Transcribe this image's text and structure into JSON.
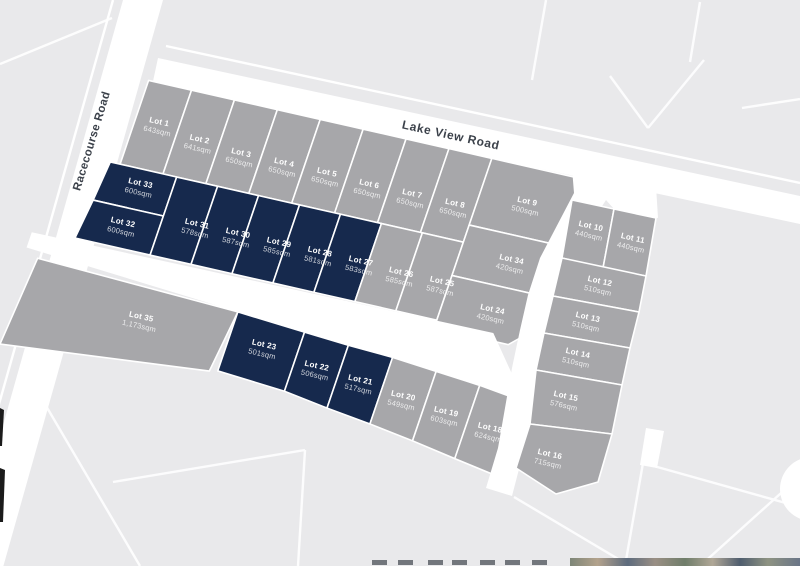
{
  "map": {
    "colors": {
      "background": "#e9e9eb",
      "lot_grey": "#a7a7aa",
      "lot_navy": "#16294d",
      "road": "#ffffff",
      "parcel_line": "#ffffff",
      "label_text": "#ffffff",
      "road_label_text": "#3b414a"
    },
    "roads": {
      "racecourse": {
        "label": "Racecourse Road"
      },
      "lake_view": {
        "label": "Lake View Road"
      }
    },
    "lots": [
      {
        "name": "Lot 1",
        "size": "643sqm",
        "highlight": false,
        "group": "main",
        "points": [
          [
            0,
            -8
          ],
          [
            44,
            -8
          ],
          [
            44,
            80
          ],
          [
            0,
            80
          ]
        ],
        "label": [
          24,
          34
        ]
      },
      {
        "name": "Lot 2",
        "size": "641sqm",
        "highlight": false,
        "group": "main",
        "points": [
          [
            44,
            -8
          ],
          [
            88,
            -8
          ],
          [
            88,
            80
          ],
          [
            44,
            80
          ]
        ],
        "label": [
          68,
          42
        ]
      },
      {
        "name": "Lot 3",
        "size": "650sqm",
        "highlight": false,
        "group": "main",
        "points": [
          [
            88,
            -8
          ],
          [
            132,
            -8
          ],
          [
            132,
            80
          ],
          [
            88,
            80
          ]
        ],
        "label": [
          112,
          46
        ]
      },
      {
        "name": "Lot 4",
        "size": "650sqm",
        "highlight": false,
        "group": "main",
        "points": [
          [
            132,
            -8
          ],
          [
            176,
            -8
          ],
          [
            176,
            80
          ],
          [
            132,
            80
          ]
        ],
        "label": [
          156,
          46
        ]
      },
      {
        "name": "Lot 5",
        "size": "650sqm",
        "highlight": false,
        "group": "main",
        "points": [
          [
            176,
            -8
          ],
          [
            220,
            -8
          ],
          [
            220,
            80
          ],
          [
            176,
            80
          ]
        ],
        "label": [
          200,
          46
        ]
      },
      {
        "name": "Lot 6",
        "size": "650sqm",
        "highlight": false,
        "group": "main",
        "points": [
          [
            220,
            -8
          ],
          [
            264,
            -8
          ],
          [
            264,
            80
          ],
          [
            220,
            80
          ]
        ],
        "label": [
          244,
          48
        ]
      },
      {
        "name": "Lot 7",
        "size": "650sqm",
        "highlight": false,
        "group": "main",
        "points": [
          [
            264,
            -8
          ],
          [
            308,
            -8
          ],
          [
            308,
            80
          ],
          [
            264,
            80
          ]
        ],
        "label": [
          288,
          48
        ]
      },
      {
        "name": "Lot 8",
        "size": "650sqm",
        "highlight": false,
        "group": "main",
        "points": [
          [
            308,
            -8
          ],
          [
            352,
            -8
          ],
          [
            352,
            80
          ],
          [
            308,
            80
          ]
        ],
        "label": [
          332,
          48
        ]
      },
      {
        "name": "Lot 9",
        "size": "500sqm",
        "highlight": false,
        "group": "main",
        "points": [
          [
            352,
            -8
          ],
          [
            448,
            -8
          ],
          [
            448,
            62
          ],
          [
            352,
            62
          ]
        ],
        "label": [
          400,
          30
        ]
      },
      {
        "name": "Lot 33",
        "size": "600sqm",
        "highlight": true,
        "group": "main",
        "points": [
          [
            -10,
            80
          ],
          [
            58,
            80
          ],
          [
            58,
            121
          ],
          [
            -14,
            121
          ]
        ],
        "label": [
          26,
          98
        ]
      },
      {
        "name": "Lot 32",
        "size": "600sqm",
        "highlight": true,
        "group": "main",
        "points": [
          [
            -14,
            121
          ],
          [
            58,
            121
          ],
          [
            58,
            162
          ],
          [
            -19,
            162
          ]
        ],
        "label": [
          22,
          140
        ]
      },
      {
        "name": "Lot 31",
        "size": "578sqm",
        "highlight": true,
        "group": "main",
        "points": [
          [
            58,
            80
          ],
          [
            100,
            80
          ],
          [
            100,
            162
          ],
          [
            58,
            162
          ]
        ],
        "label": [
          93,
          125
        ]
      },
      {
        "name": "Lot 30",
        "size": "587sqm",
        "highlight": true,
        "group": "main",
        "points": [
          [
            100,
            80
          ],
          [
            142,
            80
          ],
          [
            142,
            162
          ],
          [
            100,
            162
          ]
        ],
        "label": [
          135,
          125
        ]
      },
      {
        "name": "Lot 29",
        "size": "585sqm",
        "highlight": true,
        "group": "main",
        "points": [
          [
            142,
            80
          ],
          [
            184,
            80
          ],
          [
            184,
            162
          ],
          [
            142,
            162
          ]
        ],
        "label": [
          177,
          125
        ]
      },
      {
        "name": "Lot 28",
        "size": "581sqm",
        "highlight": true,
        "group": "main",
        "points": [
          [
            184,
            80
          ],
          [
            226,
            80
          ],
          [
            226,
            162
          ],
          [
            184,
            162
          ]
        ],
        "label": [
          219,
          125
        ]
      },
      {
        "name": "Lot 27",
        "size": "583sqm",
        "highlight": true,
        "group": "main",
        "points": [
          [
            226,
            80
          ],
          [
            268,
            80
          ],
          [
            268,
            162
          ],
          [
            226,
            162
          ]
        ],
        "label": [
          261,
          125
        ]
      },
      {
        "name": "Lot 26",
        "size": "585sqm",
        "highlight": false,
        "group": "main",
        "points": [
          [
            268,
            80
          ],
          [
            310,
            80
          ],
          [
            310,
            162
          ],
          [
            268,
            162
          ]
        ],
        "label": [
          303,
          127
        ]
      },
      {
        "name": "Lot 25",
        "size": "587sqm",
        "highlight": false,
        "group": "main",
        "points": [
          [
            310,
            80
          ],
          [
            352,
            80
          ],
          [
            352,
            162
          ],
          [
            310,
            162
          ]
        ],
        "label": [
          345,
          127
        ]
      },
      {
        "name": "Lot 34",
        "size": "420sqm",
        "highlight": false,
        "group": "main",
        "points": [
          [
            352,
            62
          ],
          [
            452,
            62
          ],
          [
            452,
            115
          ],
          [
            352,
            115
          ]
        ],
        "label": [
          404,
          90
        ]
      },
      {
        "name": "Lot 24",
        "size": "420sqm",
        "highlight": false,
        "group": "main",
        "points": [
          [
            352,
            115
          ],
          [
            452,
            115
          ],
          [
            452,
            146
          ],
          [
            428,
            170
          ],
          [
            352,
            170
          ]
        ],
        "label": [
          402,
          143
        ]
      },
      {
        "name": "Lot 35",
        "size": "1,173sqm",
        "highlight": false,
        "group": "main",
        "points": [
          [
            -48,
            190
          ],
          [
            160,
            198
          ],
          [
            152,
            262
          ],
          [
            -56,
            282
          ]
        ],
        "label": [
          70,
          228
        ]
      },
      {
        "name": "Lot 23",
        "size": "501sqm",
        "highlight": true,
        "group": "main",
        "points": [
          [
            160,
            198
          ],
          [
            230,
            203
          ],
          [
            230,
            265
          ],
          [
            160,
            260
          ]
        ],
        "label": [
          196,
          228
        ]
      },
      {
        "name": "Lot 22",
        "size": "506sqm",
        "highlight": true,
        "group": "main",
        "points": [
          [
            230,
            203
          ],
          [
            276,
            206
          ],
          [
            276,
            272
          ],
          [
            230,
            265
          ]
        ],
        "label": [
          253,
          237
        ]
      },
      {
        "name": "Lot 21",
        "size": "517sqm",
        "highlight": true,
        "group": "main",
        "points": [
          [
            276,
            206
          ],
          [
            322,
            208
          ],
          [
            322,
            278
          ],
          [
            276,
            272
          ]
        ],
        "label": [
          299,
          241
        ]
      },
      {
        "name": "Lot 20",
        "size": "549sqm",
        "highlight": false,
        "group": "main",
        "points": [
          [
            322,
            208
          ],
          [
            368,
            212
          ],
          [
            368,
            285
          ],
          [
            322,
            278
          ]
        ],
        "label": [
          345,
          247
        ]
      },
      {
        "name": "Lot 19",
        "size": "603sqm",
        "highlight": false,
        "group": "main",
        "points": [
          [
            368,
            212
          ],
          [
            414,
            216
          ],
          [
            414,
            293
          ],
          [
            368,
            285
          ]
        ],
        "label": [
          391,
          253
        ]
      },
      {
        "name": "Lot 18",
        "size": "624sqm",
        "highlight": false,
        "group": "main",
        "points": [
          [
            414,
            216
          ],
          [
            462,
            222
          ],
          [
            462,
            301
          ],
          [
            414,
            293
          ]
        ],
        "label": [
          438,
          259
        ]
      },
      {
        "name": "Lot 10",
        "size": "440sqm",
        "highlight": false,
        "group": "east",
        "points": [
          [
            572,
            200
          ],
          [
            614,
            209
          ],
          [
            603,
            268
          ],
          [
            562,
            258
          ]
        ],
        "label": [
          590,
          230
        ]
      },
      {
        "name": "Lot 11",
        "size": "440sqm",
        "highlight": false,
        "group": "east",
        "points": [
          [
            614,
            209
          ],
          [
            656,
            218
          ],
          [
            646,
            276
          ],
          [
            603,
            268
          ]
        ],
        "label": [
          632,
          242
        ]
      },
      {
        "name": "Lot 12",
        "size": "510sqm",
        "highlight": false,
        "group": "east",
        "points": [
          [
            562,
            258
          ],
          [
            646,
            276
          ],
          [
            639,
            312
          ],
          [
            553,
            296
          ]
        ],
        "label": [
          599,
          285
        ]
      },
      {
        "name": "Lot 13",
        "size": "510sqm",
        "highlight": false,
        "group": "east",
        "points": [
          [
            553,
            296
          ],
          [
            639,
            312
          ],
          [
            630,
            348
          ],
          [
            544,
            333
          ]
        ],
        "label": [
          587,
          321
        ]
      },
      {
        "name": "Lot 14",
        "size": "510sqm",
        "highlight": false,
        "group": "east",
        "points": [
          [
            544,
            333
          ],
          [
            630,
            348
          ],
          [
            622,
            385
          ],
          [
            536,
            370
          ]
        ],
        "label": [
          577,
          357
        ]
      },
      {
        "name": "Lot 15",
        "size": "576sqm",
        "highlight": false,
        "group": "east",
        "points": [
          [
            536,
            370
          ],
          [
            622,
            385
          ],
          [
            612,
            434
          ],
          [
            530,
            424
          ]
        ],
        "label": [
          565,
          400
        ]
      },
      {
        "name": "Lot 16",
        "size": "715sqm",
        "highlight": false,
        "group": "east",
        "points": [
          [
            530,
            424
          ],
          [
            612,
            434
          ],
          [
            598,
            482
          ],
          [
            556,
            494
          ],
          [
            516,
            468
          ]
        ],
        "label": [
          549,
          458
        ]
      }
    ]
  }
}
